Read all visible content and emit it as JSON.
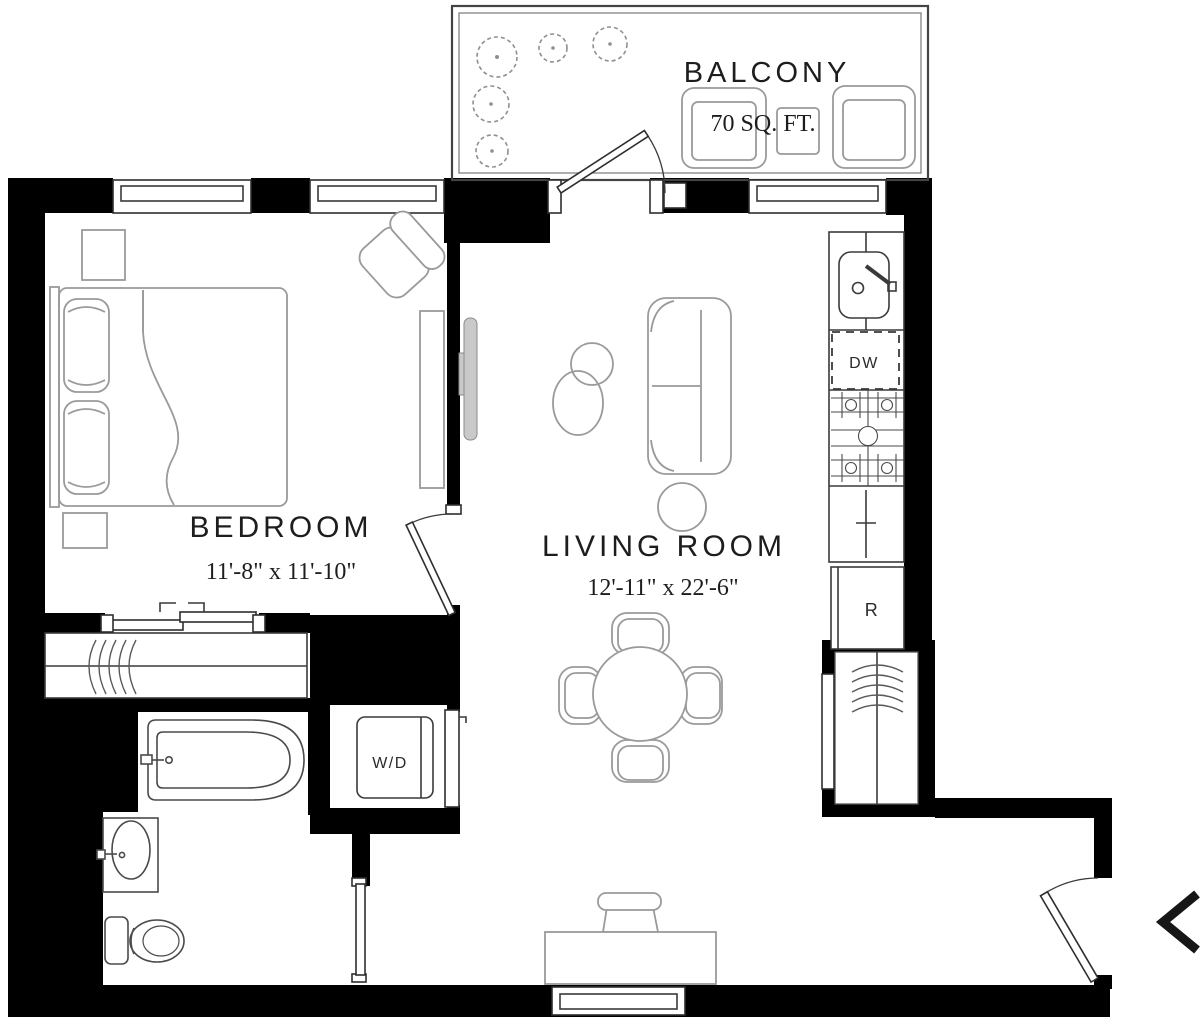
{
  "rooms": {
    "balcony": {
      "label": "BALCONY",
      "area": "70 SQ. FT."
    },
    "bedroom": {
      "label": "BEDROOM",
      "dimensions": "11'-8\" x 11'-10\""
    },
    "living_room": {
      "label": "LIVING ROOM",
      "dimensions": "12'-11\" x 22'-6\""
    }
  },
  "appliances": {
    "dishwasher_label": "DW",
    "refrigerator_label": "R",
    "washer_dryer_label": "W/D"
  },
  "nav": {
    "prev_icon": "chevron-left"
  },
  "colors": {
    "wall": "#000000",
    "fixture_line": "#3a3a3a",
    "furniture_line": "#9a9a9a",
    "text": "#1d1d1d",
    "background": "#ffffff"
  }
}
